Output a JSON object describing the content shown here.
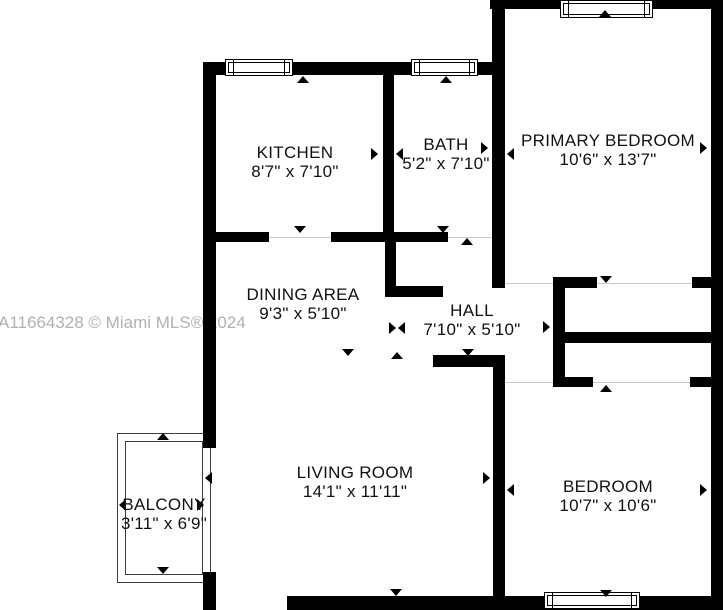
{
  "watermark": "A11664328 © Miami MLS® 2024",
  "rooms": [
    {
      "name": "KITCHEN",
      "dimensions": "8'7\" x 7'10\""
    },
    {
      "name": "BATH",
      "dimensions": "5'2\" x 7'10\""
    },
    {
      "name": "PRIMARY BEDROOM",
      "dimensions": "10'6\" x 13'7\""
    },
    {
      "name": "DINING AREA",
      "dimensions": "9'3\" x 5'10\""
    },
    {
      "name": "HALL",
      "dimensions": "7'10\" x 5'10\""
    },
    {
      "name": "LIVING ROOM",
      "dimensions": "14'1\" x 11'11\""
    },
    {
      "name": "BEDROOM",
      "dimensions": "10'7\" x 10'6\""
    },
    {
      "name": "BALCONY",
      "dimensions": "3'11\" x 6'9\""
    }
  ],
  "colors": {
    "wall": "#000000",
    "background": "#ffffff",
    "watermark": "#b3b0ad"
  },
  "icons": {
    "door_marker": "triangle",
    "window": "double-line-window"
  }
}
